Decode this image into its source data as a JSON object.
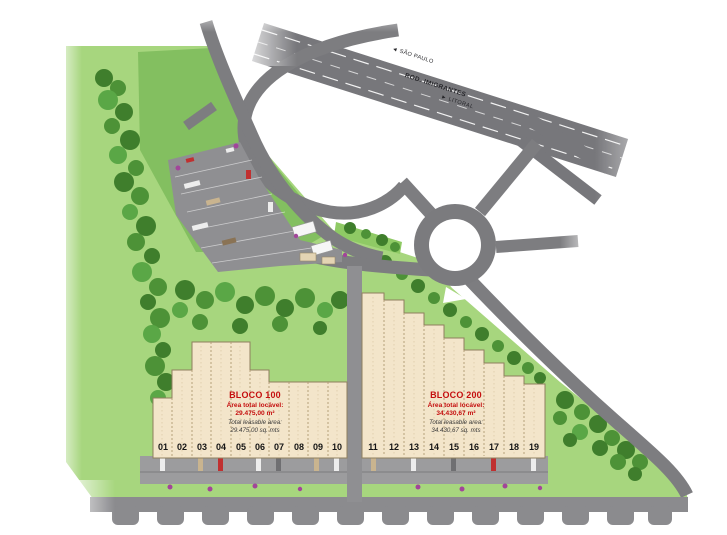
{
  "site": {
    "bloco100": {
      "title": "BLOCO 100",
      "area_label_pt": "Área total locável:",
      "area_value_pt": "29.475,00 m²",
      "area_label_en": "Total leasable area:",
      "area_value_en": "29.475,00 sq. mts",
      "units": [
        "01",
        "02",
        "03",
        "04",
        "05",
        "06",
        "07",
        "08",
        "09",
        "10"
      ]
    },
    "bloco200": {
      "title": "BLOCO 200",
      "area_label_pt": "Área total locável:",
      "area_value_pt": "34.430,67 m²",
      "area_label_en": "Total leasable area:",
      "area_value_en": "34.430,67 sq. mts",
      "units": [
        "11",
        "12",
        "13",
        "14",
        "15",
        "16",
        "17",
        "18",
        "19"
      ]
    },
    "highway": {
      "name": "ROD. IMIGRANTES",
      "direction_left": "◄ SÃO PAULO",
      "direction_right": "► LITORAL"
    },
    "colors": {
      "grass": "#a7d67e",
      "grass_dark": "#7cbb5b",
      "tree": "#3f7e2c",
      "road": "#7d7d80",
      "building": "#f3e5ca",
      "accent_red": "#c50f0f"
    }
  }
}
